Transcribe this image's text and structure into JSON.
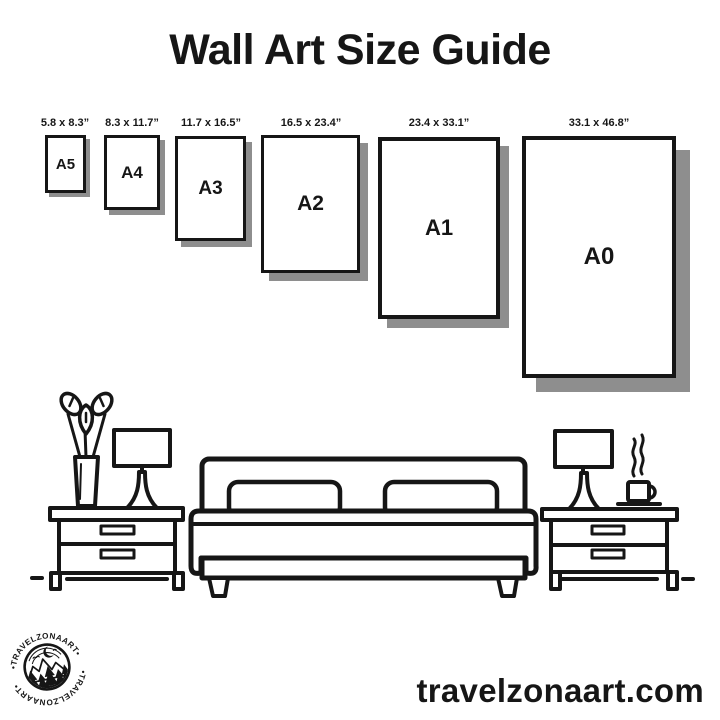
{
  "title": "Wall Art Size Guide",
  "sizes": [
    {
      "label": "A5",
      "dimensions": "5.8 x 8.3”"
    },
    {
      "label": "A4",
      "dimensions": "8.3 x 11.7”"
    },
    {
      "label": "A3",
      "dimensions": "11.7 x 16.5”"
    },
    {
      "label": "A2",
      "dimensions": "16.5 x 23.4”"
    },
    {
      "label": "A1",
      "dimensions": "23.4 x 33.1”"
    },
    {
      "label": "A0",
      "dimensions": "33.1 x 46.8”"
    }
  ],
  "illustration_icons": [
    "plant-vase-icon",
    "table-lamp-left-icon",
    "nightstand-left-icon",
    "bed-icon",
    "nightstand-right-icon",
    "table-lamp-right-icon",
    "coffee-cup-icon"
  ],
  "brand": {
    "logo_text_top": "•TRAVELZONAART•",
    "logo_text_bottom": "•TRAVELZONAART•",
    "website": "travelzonaart.com"
  },
  "colors": {
    "ink": "#161616",
    "shadow": "#8e8e8e",
    "bg": "#ffffff"
  }
}
